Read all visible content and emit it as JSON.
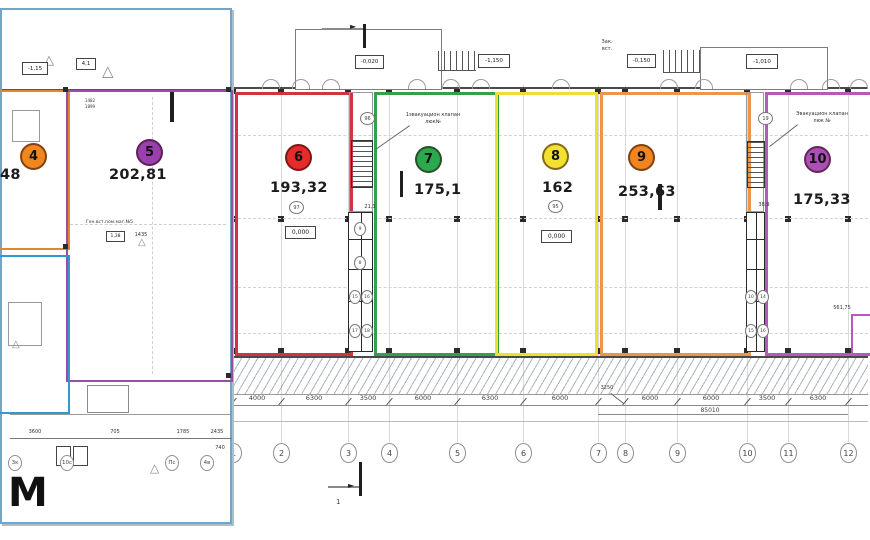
{
  "panel": {
    "units": [
      {
        "id": "4",
        "area": "48",
        "color": "#e2862f"
      },
      {
        "id": "5",
        "area": "202,81",
        "color": "#9a4da6"
      }
    ],
    "note": "Ген.вст.пом.маг.№5",
    "note2a": "1482",
    "note2b": "1899",
    "small_box1": "-1,15",
    "small_box2": "4,1",
    "small_box3": "1,38",
    "small_num": "1435",
    "dim_extra": "740",
    "dims": [
      "3600",
      "705",
      "1785",
      "2435"
    ],
    "axis_letters": [
      "3к",
      "10с",
      "Пс",
      "4в"
    ],
    "big_letter": "М"
  },
  "plan": {
    "units": [
      {
        "id": "6",
        "area": "193,32",
        "color": "#cf3540",
        "fill": "#e62b2b"
      },
      {
        "id": "7",
        "area": "175,1",
        "color": "#35a04c",
        "fill": "#2ca84e"
      },
      {
        "id": "8",
        "area": "162",
        "color": "#efdf33",
        "fill": "#f2e12e"
      },
      {
        "id": "9",
        "area": "253,63",
        "color": "#eb964a",
        "fill": "#f08522"
      },
      {
        "id": "10",
        "area": "175,33",
        "color": "#b55ab8",
        "fill": "#a94fb5"
      }
    ],
    "tags": {
      "u6": "97",
      "u8": "95",
      "u7top": "96",
      "u10top": "19",
      "s1": [
        "9",
        "8",
        "15",
        "16",
        "17",
        "18"
      ],
      "s2": [
        "10",
        "14",
        "15",
        "16"
      ]
    },
    "elevations": {
      "canopy1": "-0,020",
      "right1": "-1,150",
      "left2": "-0,150",
      "canopy2": "-1,010",
      "floor1": "0,000",
      "floor2": "0,000"
    },
    "annotations": {
      "evac1a": "1эвакуацион клапан",
      "evac1b": "люк№",
      "evac2a": "Эвакуацион клапан",
      "evac2b": "люк №",
      "shaft_dim1": "21,3",
      "shaft_dim2": "38,9",
      "total": "85010",
      "area_note": "561,75",
      "note_a": "Зак.",
      "note_b": "вст.",
      "section_mark": "1"
    },
    "axes": {
      "labels": [
        "1",
        "2",
        "3",
        "4",
        "5",
        "6",
        "7",
        "8",
        "9",
        "10",
        "11",
        "12"
      ],
      "dims": [
        "4000",
        "6300",
        "3500",
        "6000",
        "6300",
        "6000",
        "3250",
        "6000",
        "6000",
        "3500",
        "6300"
      ]
    }
  }
}
